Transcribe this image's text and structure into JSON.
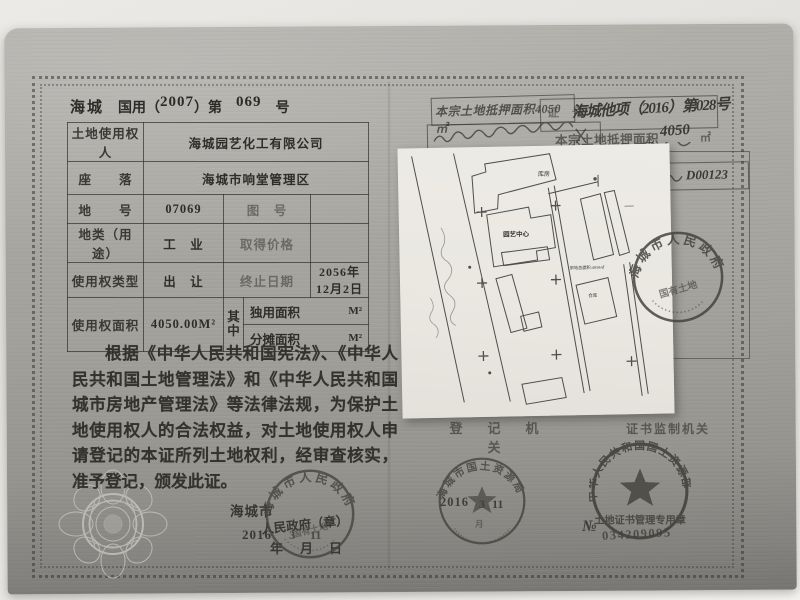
{
  "serial": {
    "region": "海城",
    "type_label": "国用（",
    "year": "2007",
    "mid_label": "）第",
    "number": "069",
    "suffix_label": "号"
  },
  "table": {
    "row1_label": "土地使用权人",
    "row1_value": "海城园艺化工有限公司",
    "row2_label": "座　　落",
    "row2_value": "海城市响堂管理区",
    "row3_label": "地　　号",
    "row3_value": "07069",
    "row3_label2": "图　号",
    "row3_value2": "",
    "row4_label": "地类（用途）",
    "row4_value": "工　业",
    "row4_label2": "取得价格",
    "row4_value2": "",
    "row5_label": "使用权类型",
    "row5_value": "出　让",
    "row5_label2": "终止日期",
    "row5_value2": "2056年12月2日",
    "row6_label": "使用权面积",
    "row6_value": "4050.00M²",
    "row6_mid": "其中",
    "row6_sub1_label": "独用面积",
    "row6_sub1_unit": "M²",
    "row6_sub2_label": "分摊面积",
    "row6_sub2_unit": "M²"
  },
  "paragraph": "根据《中华人民共和国宪法》、《中华人民共和国土地管理法》和《中华人民共和国城市房地产管理法》等法律法规，为保护土地使用权人的合法权益，对土地使用权人申请登记的本证所列土地权利，经审查核实，准予登记，颁发此证。",
  "issue": {
    "city": "海城市",
    "gov_label": "人民政府（章）",
    "year": "2016",
    "year_label": "年",
    "month": "3",
    "month_label": "月",
    "day": "11",
    "day_label": "日"
  },
  "annotations": {
    "mortgage_box_line1": "本宗土地抵押面积4050㎡",
    "cert_no_label": "证　号",
    "cert_no_value": "海城他项（2016）第028号",
    "mortgage_line_prefix": "本宗土地抵押面积",
    "mortgage_line_number": "4050",
    "mortgage_line_unit": "㎡",
    "note_box_value": "D00123",
    "registry_header": "登　记　机　关",
    "supervisor_header": "证书监制机关"
  },
  "map": {
    "label_top": "库房",
    "label_center": "园艺中心",
    "label_area": "宗地总面积:4050㎡",
    "label_small": "仓库",
    "dash": "—"
  },
  "stamps": {
    "gov_rim": "海城市人民政府",
    "gov_inner": "国有土地",
    "bureau_rim": "海城市国土资源局",
    "bureau_date_year": "2016",
    "bureau_date_month": "3",
    "bureau_date_day": "11",
    "bureau_month_label": "月",
    "ministry_rim": "中华人民共和国国土资源部",
    "ministry_bottom": "土地证书管理专用章",
    "ministry_no_prefix": "№",
    "ministry_no": "034209095"
  }
}
